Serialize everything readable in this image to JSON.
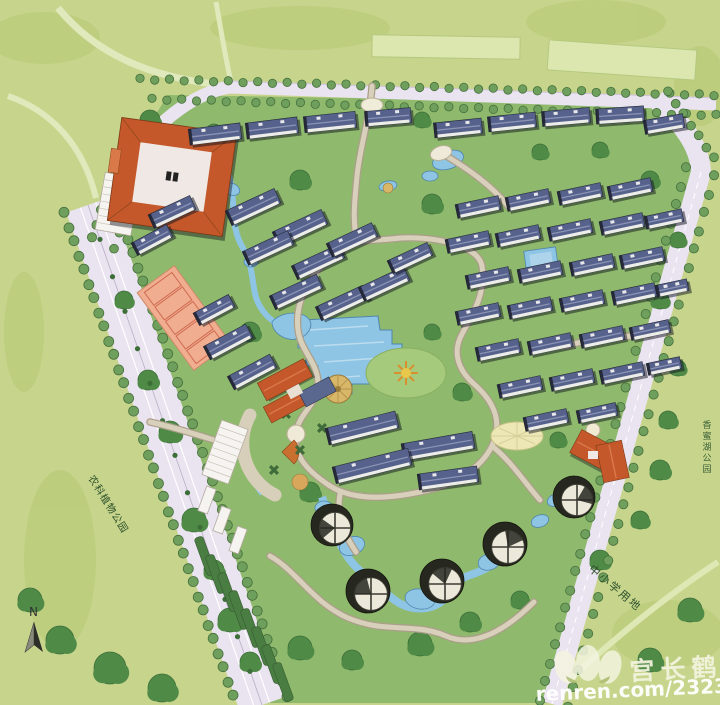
{
  "title": "residential-community-master-plan",
  "watermark": {
    "name": "宫长鹤",
    "url": "renren.com/232333316",
    "logo": "renren-petal-logo"
  },
  "compass": {
    "label": "N"
  },
  "colors": {
    "bg": "#c7d58c",
    "bgBlob": "#b9cb79",
    "site": "#8fb96c",
    "road": "#eae3f0",
    "roadEdge": "#c9bcd6",
    "roadLine": "#ffffff",
    "roadTree": "#6f9f5d",
    "roadTreeEdge": "#46703c",
    "treeDark": "#4f8a47",
    "treeDarkEdge": "#3c6e38",
    "water": "#8ec4e4",
    "waterEdge": "#4f86ad",
    "pathFill": "#d9d0bc",
    "pathEdge": "#ab9f8a",
    "roofBlue": "#56628c",
    "roofBlueLight": "#8a93b5",
    "wall": "#f4f3ee",
    "roofOrange": "#c4582b",
    "roofOrangeLight": "#d9794a",
    "towerDark": "#26271f",
    "towerTop": "#ece8da",
    "parcel": "#dbe7ae",
    "parcelEdge": "#b4c87e",
    "hedge": "#4a7d42",
    "courtFill": "#f0ad90",
    "courtLine": "#cf6a50",
    "gold": "#d8b768",
    "lawn": "#a6ca7c",
    "palePlaza": "#ece7b4",
    "labelGreen": "#2c4f2a",
    "wmCream": "#f4f4e0"
  },
  "labels": [
    {
      "text": "农科植物公园",
      "x": 88,
      "y": 478,
      "rot": 58,
      "size": 10,
      "spacing": 1,
      "color": "#2c4f2a",
      "vertical": false
    },
    {
      "text": "中小学用地",
      "x": 588,
      "y": 570,
      "rot": 40,
      "size": 11,
      "spacing": 2,
      "color": "#2c4f2a",
      "vertical": false
    },
    {
      "text": "香蜜湖公园",
      "x": 707,
      "y": 428,
      "rot": 0,
      "size": 9,
      "spacing": 0,
      "color": "#3a5f35",
      "vertical": true
    }
  ],
  "features": {
    "parcels": [
      [
        446,
        47,
        148,
        22,
        1
      ],
      [
        622,
        60,
        148,
        30,
        4
      ]
    ],
    "treeRows": [
      {
        "a": [
          140,
          79
        ],
        "b": [
          714,
          95
        ],
        "n": 40,
        "r": 4.2
      },
      {
        "a": [
          152,
          99
        ],
        "b": [
          716,
          115
        ],
        "n": 39,
        "r": 4.2
      },
      {
        "a": [
          128,
          128
        ],
        "b": [
          92,
          238
        ],
        "n": 9,
        "r": 4.6
      },
      {
        "a": [
          152,
          146
        ],
        "b": [
          114,
          248
        ],
        "n": 8,
        "r": 4.4
      },
      {
        "a": [
          64,
          213
        ],
        "b": [
          238,
          710
        ],
        "n": 36,
        "r": 5
      },
      {
        "a": [
          113,
          196
        ],
        "b": [
          287,
          696
        ],
        "n": 36,
        "r": 5
      },
      {
        "a": [
          686,
          168
        ],
        "b": [
          540,
          700
        ],
        "n": 30,
        "r": 4.6
      },
      {
        "a": [
          714,
          176
        ],
        "b": [
          568,
          706
        ],
        "n": 30,
        "r": 4.6
      },
      {
        "a": [
          668,
          92
        ],
        "b": [
          714,
          158
        ],
        "n": 7,
        "r": 4.4
      },
      {
        "a": [
          100,
          240
        ],
        "b": [
          250,
          672
        ],
        "n": 13,
        "r": 2.6,
        "dark": true
      }
    ],
    "clumps": [
      [
        150,
        120,
        10
      ],
      [
        176,
        162,
        12
      ],
      [
        140,
        202,
        9
      ],
      [
        124,
        300,
        9
      ],
      [
        148,
        380,
        10
      ],
      [
        170,
        432,
        11
      ],
      [
        194,
        520,
        12
      ],
      [
        214,
        570,
        10
      ],
      [
        230,
        620,
        12
      ],
      [
        250,
        662,
        10
      ],
      [
        300,
        648,
        12
      ],
      [
        352,
        660,
        10
      ],
      [
        420,
        644,
        12
      ],
      [
        470,
        622,
        10
      ],
      [
        520,
        600,
        9
      ],
      [
        600,
        560,
        10
      ],
      [
        640,
        520,
        9
      ],
      [
        660,
        470,
        10
      ],
      [
        668,
        420,
        9
      ],
      [
        678,
        368,
        8
      ],
      [
        660,
        300,
        9
      ],
      [
        678,
        240,
        8
      ],
      [
        650,
        180,
        9
      ],
      [
        600,
        150,
        8
      ],
      [
        432,
        204,
        10
      ],
      [
        300,
        180,
        10
      ],
      [
        250,
        332,
        10
      ],
      [
        432,
        332,
        8
      ],
      [
        462,
        392,
        9
      ],
      [
        310,
        492,
        10
      ],
      [
        558,
        440,
        8
      ],
      [
        362,
        352,
        8
      ],
      [
        60,
        640,
        14
      ],
      [
        110,
        668,
        16
      ],
      [
        162,
        688,
        14
      ],
      [
        30,
        600,
        12
      ],
      [
        214,
        132,
        8
      ],
      [
        422,
        120,
        8
      ],
      [
        540,
        152,
        8
      ],
      [
        690,
        610,
        12
      ],
      [
        650,
        660,
        12
      ]
    ],
    "buildings": [
      [
        215,
        134,
        52,
        16,
        -7
      ],
      [
        272,
        128,
        52,
        16,
        -7
      ],
      [
        330,
        122,
        52,
        16,
        -6
      ],
      [
        388,
        117,
        46,
        15,
        -5
      ],
      [
        458,
        128,
        48,
        15,
        -6
      ],
      [
        512,
        122,
        48,
        15,
        -6
      ],
      [
        566,
        117,
        48,
        15,
        -5
      ],
      [
        620,
        115,
        48,
        15,
        -4
      ],
      [
        664,
        124,
        40,
        14,
        -10
      ],
      [
        253,
        207,
        54,
        16,
        -25
      ],
      [
        300,
        228,
        54,
        16,
        -25
      ],
      [
        268,
        248,
        50,
        15,
        -25
      ],
      [
        318,
        262,
        52,
        15,
        -25
      ],
      [
        352,
        240,
        50,
        15,
        -25
      ],
      [
        296,
        292,
        52,
        15,
        -25
      ],
      [
        342,
        303,
        52,
        15,
        -25
      ],
      [
        384,
        284,
        50,
        15,
        -25
      ],
      [
        410,
        258,
        44,
        14,
        -25
      ],
      [
        172,
        212,
        46,
        15,
        -25
      ],
      [
        152,
        240,
        40,
        14,
        -28
      ],
      [
        228,
        342,
        48,
        15,
        -28
      ],
      [
        252,
        372,
        48,
        15,
        -28
      ],
      [
        214,
        310,
        40,
        14,
        -28
      ],
      [
        362,
        428,
        72,
        17,
        -14
      ],
      [
        438,
        446,
        72,
        17,
        -10
      ],
      [
        372,
        466,
        78,
        17,
        -14
      ],
      [
        448,
        478,
        60,
        16,
        -8
      ],
      [
        478,
        207,
        44,
        14,
        -12
      ],
      [
        528,
        200,
        44,
        14,
        -12
      ],
      [
        580,
        194,
        44,
        14,
        -12
      ],
      [
        630,
        189,
        44,
        14,
        -12
      ],
      [
        468,
        242,
        44,
        14,
        -12
      ],
      [
        518,
        236,
        44,
        14,
        -12
      ],
      [
        570,
        230,
        44,
        14,
        -12
      ],
      [
        622,
        224,
        44,
        14,
        -12
      ],
      [
        664,
        219,
        38,
        13,
        -12
      ],
      [
        488,
        278,
        44,
        14,
        -12
      ],
      [
        540,
        272,
        44,
        14,
        -12
      ],
      [
        592,
        265,
        44,
        14,
        -12
      ],
      [
        642,
        258,
        44,
        14,
        -12
      ],
      [
        478,
        314,
        44,
        14,
        -12
      ],
      [
        530,
        308,
        44,
        14,
        -12
      ],
      [
        582,
        301,
        44,
        14,
        -12
      ],
      [
        634,
        294,
        44,
        14,
        -12
      ],
      [
        672,
        288,
        32,
        12,
        -12
      ],
      [
        498,
        350,
        44,
        14,
        -12
      ],
      [
        550,
        344,
        44,
        14,
        -12
      ],
      [
        602,
        337,
        44,
        14,
        -12
      ],
      [
        650,
        330,
        40,
        13,
        -12
      ],
      [
        520,
        387,
        44,
        14,
        -12
      ],
      [
        572,
        380,
        44,
        14,
        -12
      ],
      [
        622,
        373,
        44,
        14,
        -12
      ],
      [
        664,
        366,
        34,
        12,
        -12
      ],
      [
        546,
        420,
        44,
        14,
        -12
      ],
      [
        597,
        413,
        40,
        13,
        -12
      ]
    ],
    "towers": [
      [
        332,
        525,
        21
      ],
      [
        368,
        591,
        22
      ],
      [
        442,
        581,
        22
      ],
      [
        505,
        544,
        22
      ],
      [
        574,
        497,
        21
      ]
    ],
    "hedges": [
      [
        205,
        556,
        40,
        9,
        70
      ],
      [
        216,
        574,
        40,
        9,
        70
      ],
      [
        228,
        592,
        40,
        9,
        70
      ],
      [
        239,
        610,
        40,
        9,
        70
      ],
      [
        251,
        628,
        40,
        9,
        70
      ],
      [
        262,
        646,
        40,
        9,
        70
      ],
      [
        272,
        664,
        40,
        9,
        70
      ],
      [
        283,
        682,
        40,
        9,
        70
      ]
    ],
    "parking": [
      [
        118,
        204,
        36,
        58,
        10,
        7
      ],
      [
        225,
        452,
        28,
        58,
        20,
        7
      ],
      [
        207,
        500,
        10,
        26,
        20,
        0
      ],
      [
        222,
        520,
        10,
        26,
        20,
        0
      ],
      [
        238,
        540,
        10,
        26,
        20,
        0
      ]
    ],
    "xbeds": [
      [
        286,
        414
      ],
      [
        300,
        450
      ],
      [
        274,
        470
      ],
      [
        322,
        428
      ]
    ],
    "ponds": [
      [
        448,
        160,
        16,
        9,
        -18
      ],
      [
        388,
        186,
        9,
        5,
        -10
      ],
      [
        430,
        176,
        8,
        5,
        0
      ],
      [
        231,
        189,
        9,
        6,
        20
      ],
      [
        251,
        262,
        7,
        5,
        0
      ],
      [
        352,
        546,
        13,
        9,
        -20
      ],
      [
        420,
        599,
        15,
        10,
        10
      ],
      [
        489,
        562,
        11,
        8,
        -15
      ],
      [
        540,
        521,
        9,
        6,
        -20
      ],
      [
        324,
        508,
        9,
        7,
        0
      ],
      [
        556,
        500,
        9,
        6,
        -20
      ]
    ]
  }
}
